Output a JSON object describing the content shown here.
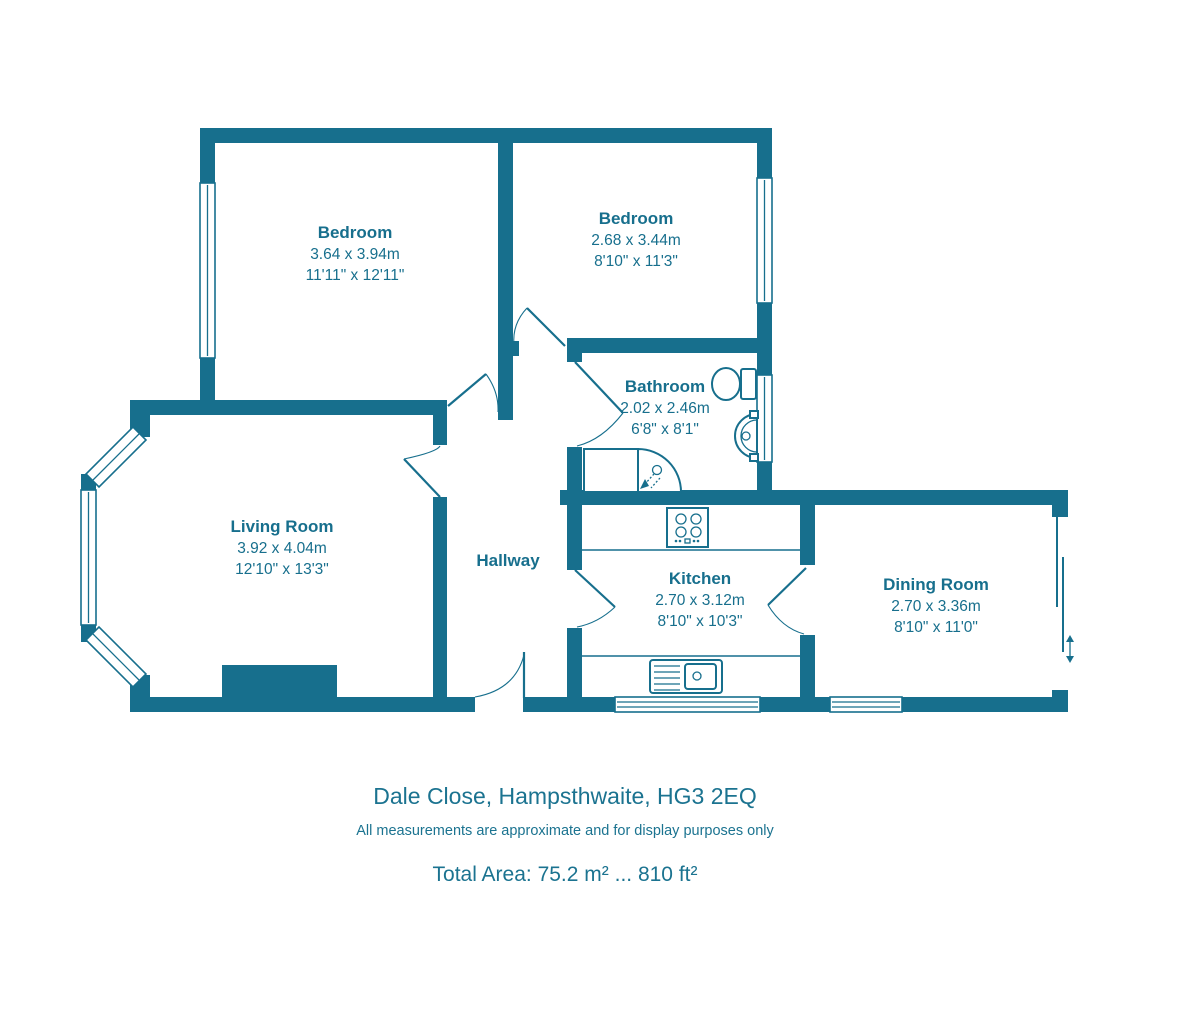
{
  "colors": {
    "wall": "#176F8D",
    "text": "#1B7390"
  },
  "rooms": {
    "bedroom1": {
      "name": "Bedroom",
      "metric": "3.64 x 3.94m",
      "imperial": "11'11\" x 12'11\""
    },
    "bedroom2": {
      "name": "Bedroom",
      "metric": "2.68 x 3.44m",
      "imperial": "8'10\" x 11'3\""
    },
    "bathroom": {
      "name": "Bathroom",
      "metric": "2.02 x 2.46m",
      "imperial": "6'8\" x 8'1\""
    },
    "living_room": {
      "name": "Living Room",
      "metric": "3.92 x 4.04m",
      "imperial": "12'10\" x 13'3\""
    },
    "hallway": {
      "name": "Hallway"
    },
    "kitchen": {
      "name": "Kitchen",
      "metric": "2.70 x 3.12m",
      "imperial": "8'10\" x 10'3\""
    },
    "dining_room": {
      "name": "Dining Room",
      "metric": "2.70 x 3.36m",
      "imperial": "8'10\" x 11'0\""
    }
  },
  "footer": {
    "address": "Dale Close, Hampsthwaite, HG3 2EQ",
    "disclaimer": "All measurements are approximate and for display purposes only",
    "total_area": "Total Area: 75.2 m² ... 810 ft²"
  }
}
